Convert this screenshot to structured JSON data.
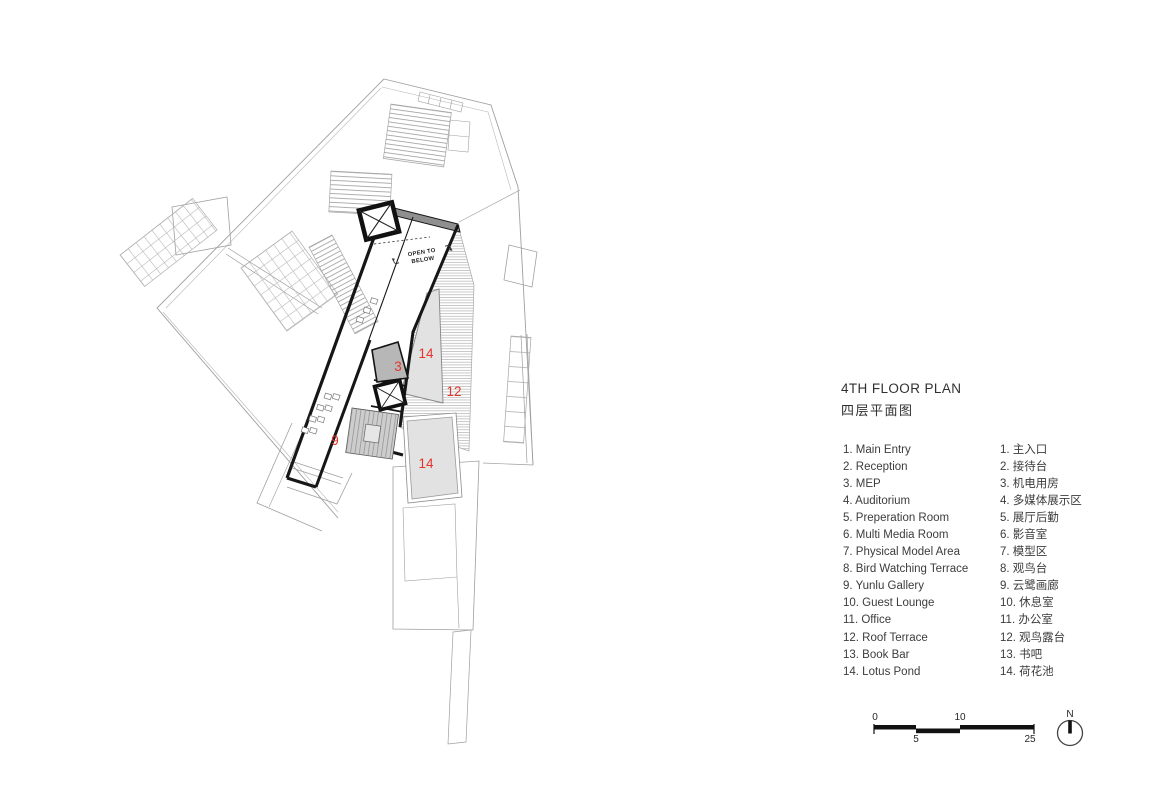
{
  "title": {
    "en": "4TH FLOOR PLAN",
    "zh": "四层平面图"
  },
  "legend": {
    "items": [
      {
        "en": "1. Main Entry",
        "zh": "1. 主入口"
      },
      {
        "en": "2. Reception",
        "zh": "2. 接待台"
      },
      {
        "en": "3. MEP",
        "zh": "3. 机电用房"
      },
      {
        "en": "4. Auditorium",
        "zh": "4. 多媒体展示区"
      },
      {
        "en": "5. Preperation Room",
        "zh": "5. 展厅后勤"
      },
      {
        "en": "6. Multi Media Room",
        "zh": "6. 影音室"
      },
      {
        "en": "7. Physical Model Area",
        "zh": "7. 模型区"
      },
      {
        "en": "8. Bird Watching Terrace",
        "zh": "8. 观鸟台"
      },
      {
        "en": "9. Yunlu Gallery",
        "zh": "9. 云鹭画廊"
      },
      {
        "en": "10. Guest Lounge",
        "zh": "10. 休息室"
      },
      {
        "en": "11. Office",
        "zh": "11. 办公室"
      },
      {
        "en": "12. Roof Terrace",
        "zh": "12. 观鸟露台"
      },
      {
        "en": "13. Book Bar",
        "zh": "13. 书吧"
      },
      {
        "en": "14. Lotus Pond",
        "zh": "14. 荷花池"
      }
    ]
  },
  "plan": {
    "open_to_below_line1": "OPEN TO",
    "open_to_below_line2": "BELOW",
    "room_labels": [
      {
        "room": "mep",
        "text": "3"
      },
      {
        "room": "lotus-pond-upper",
        "text": "14"
      },
      {
        "room": "roof-terrace",
        "text": "12"
      },
      {
        "room": "yunlu-gallery",
        "text": "9"
      },
      {
        "room": "lotus-pond-lower",
        "text": "14"
      }
    ]
  },
  "scale_bar": {
    "tick_0": "0",
    "tick_5": "5",
    "tick_10": "10",
    "tick_25": "25"
  },
  "north_arrow": {
    "label": "N"
  },
  "colors": {
    "label_red": "#e5352b",
    "wall_black": "#161616",
    "context_gray": "#9f9f9f",
    "pond_fill": "#e2e2e2"
  }
}
